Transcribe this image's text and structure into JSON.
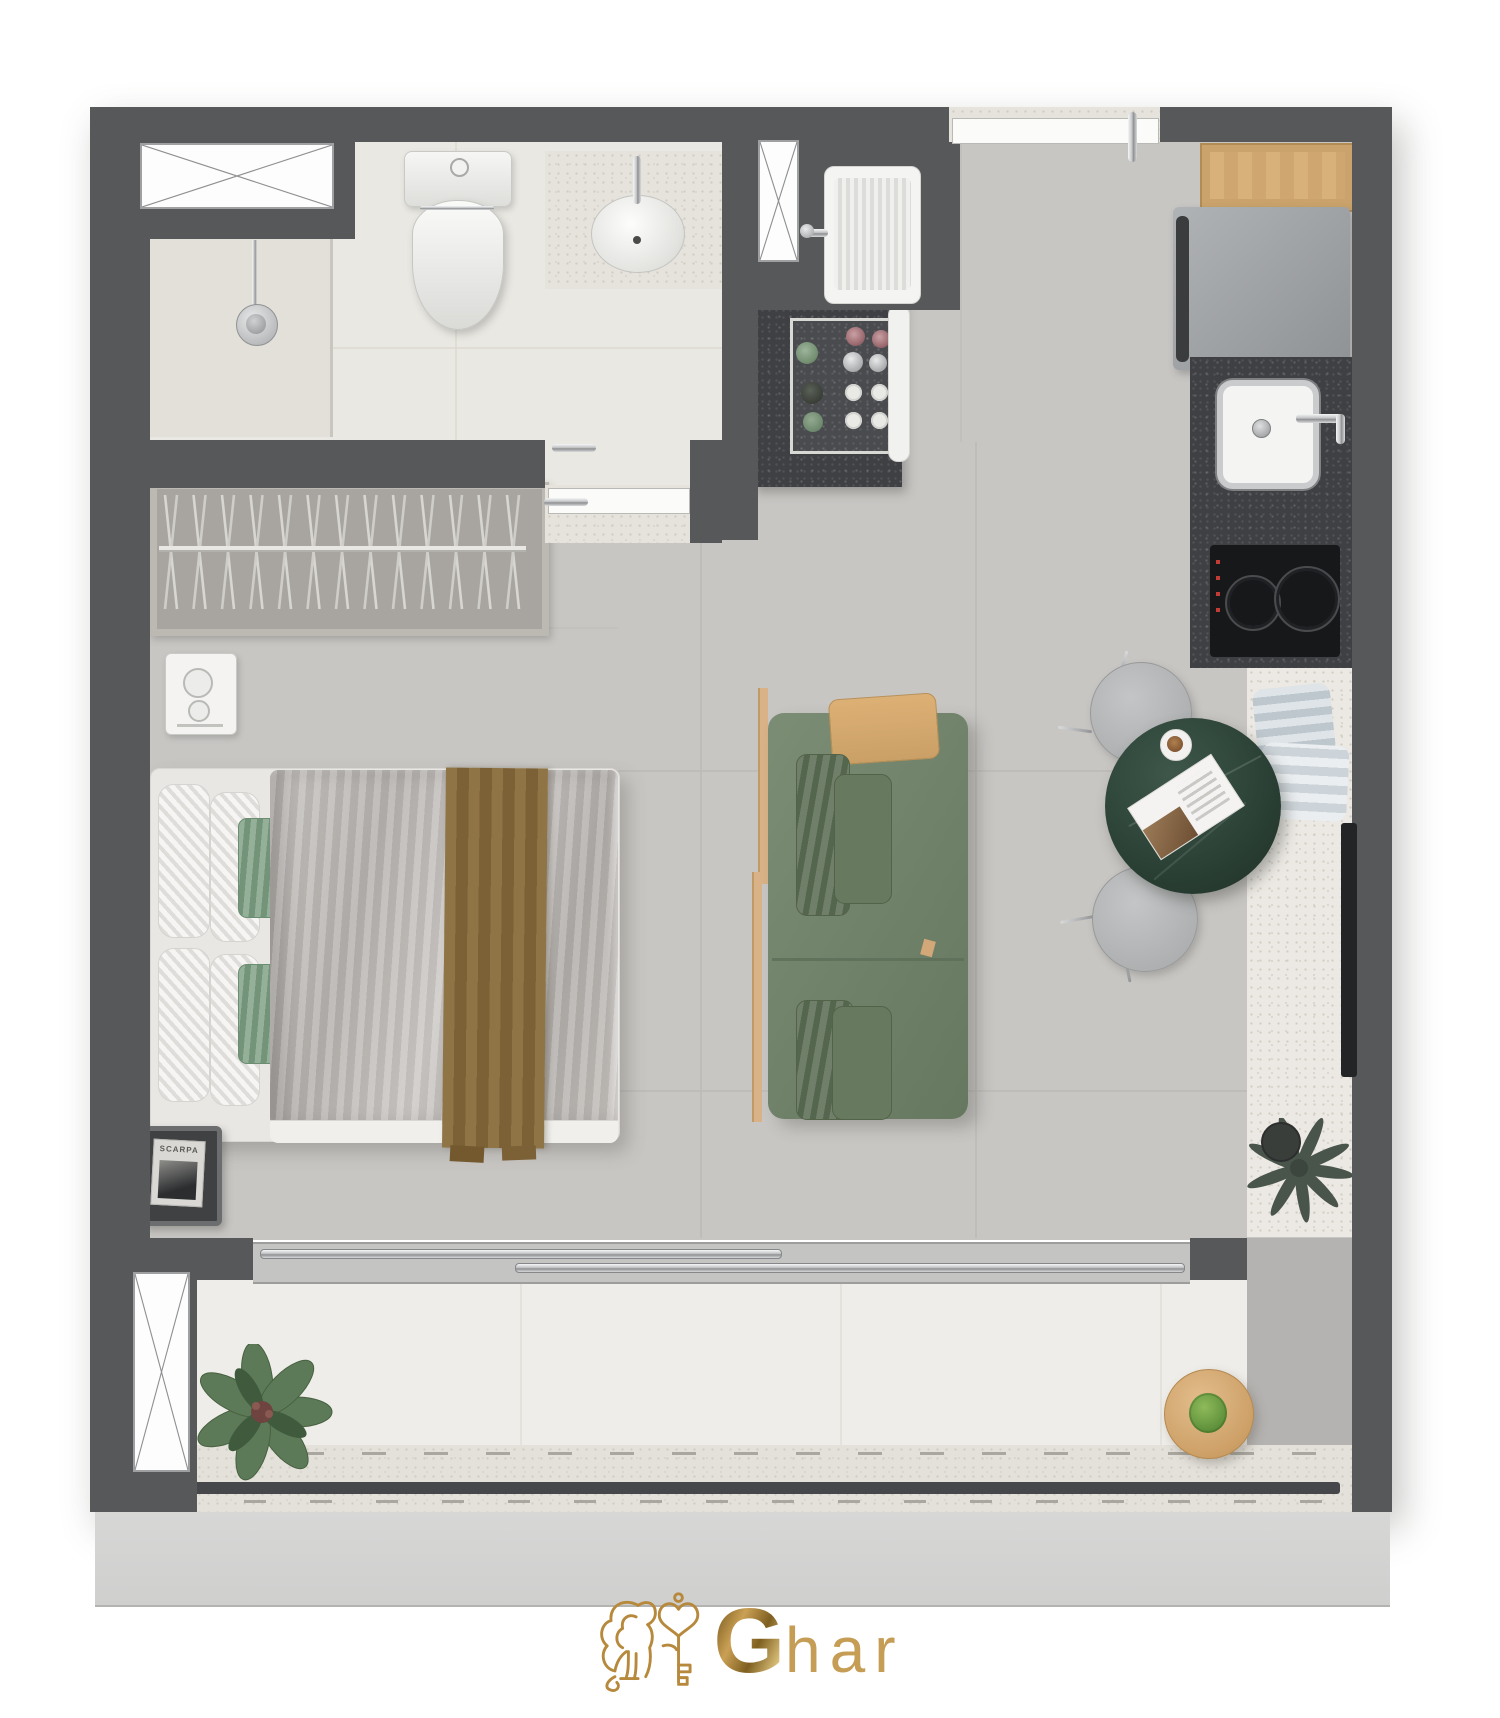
{
  "brand": {
    "logo_initial": "G",
    "logo_rest": "har",
    "gold": "#B68A3E"
  },
  "labels": {
    "magazine_title": "SCARPA"
  },
  "palette": {
    "wall": "#57585A",
    "floor": "#C8C6C3",
    "bathroom_floor": "#EAE8E2",
    "balcony_floor": "#EFEDE9",
    "terrazzo": "#E4E1DA",
    "counter_stone": "#3E4043",
    "wood": "#D3A878",
    "sofa_green": "#75876E",
    "sofa_cushion": "#5F7158",
    "table_marble": "#2F473C",
    "chair_gray": "#B4B6B7",
    "duvet_silver": "#BDB9B6",
    "throw_brown": "#8D7245",
    "pillow_green": "#7FA184",
    "towel_blue": "#CDD6DA",
    "railing": "#46474A",
    "plinth": "#D4D4D3"
  }
}
